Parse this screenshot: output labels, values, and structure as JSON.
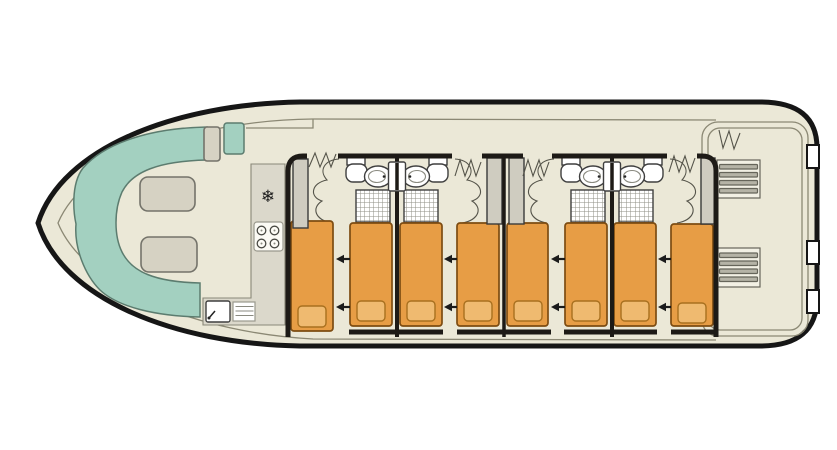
{
  "diagram": {
    "type": "boat-deck-floor-plan",
    "orientation": "bow-left-stern-right",
    "bow_salon": {
      "bench": "u-shaped-bench",
      "bench_cushions": 2,
      "helm_seats": 2
    },
    "galley": {
      "fridge_icon_glyph": "❄",
      "hob_burners": 4,
      "sink": true,
      "drainer": true
    },
    "cabins": [
      {
        "name": "cabin-1",
        "beds": 2,
        "slide_together_arrows": 2,
        "bathroom": {
          "toilet": true,
          "washbasin": true,
          "shower": true
        },
        "wardrobe": true
      },
      {
        "name": "cabin-2",
        "beds": 2,
        "slide_together_arrows": 2,
        "bathroom": {
          "toilet": true,
          "washbasin": true,
          "shower": true
        },
        "wardrobe": true
      },
      {
        "name": "cabin-3",
        "beds": 2,
        "slide_together_arrows": 2,
        "bathroom": {
          "toilet": true,
          "washbasin": true,
          "shower": true
        },
        "wardrobe": true
      },
      {
        "name": "cabin-4",
        "beds": 2,
        "slide_together_arrows": 2,
        "bathroom": {
          "toilet": true,
          "washbasin": true,
          "shower": true
        },
        "wardrobe": true
      }
    ],
    "stern_deck": {
      "stair_sets": 2,
      "hull_gates": 3
    }
  },
  "colors": {
    "floor": "#ebe8d7",
    "hull": "#161616",
    "wall": "#1d1a16",
    "thin_line": "#8b8874",
    "bench": "#a3d0c0",
    "bench_stroke": "#5c7c6f",
    "cushion": "#d6d2c3",
    "cushion_stroke": "#74736a",
    "counter": "#dbd8cb",
    "counter_stroke": "#8a8878",
    "bed": "#e79d45",
    "bed_stroke": "#7d4c12",
    "pillow": "#efba70",
    "pillow_stroke": "#a8701f",
    "white": "#ffffff",
    "fixture_stroke": "#3f3f3f",
    "wardrobe": "#cfccc0",
    "wardrobe_stroke": "#3a3a3a",
    "arrow": "#1b1b1b",
    "stairs_bg": "#f2f0e4",
    "stairs_stripe": "#b5b3a6"
  }
}
